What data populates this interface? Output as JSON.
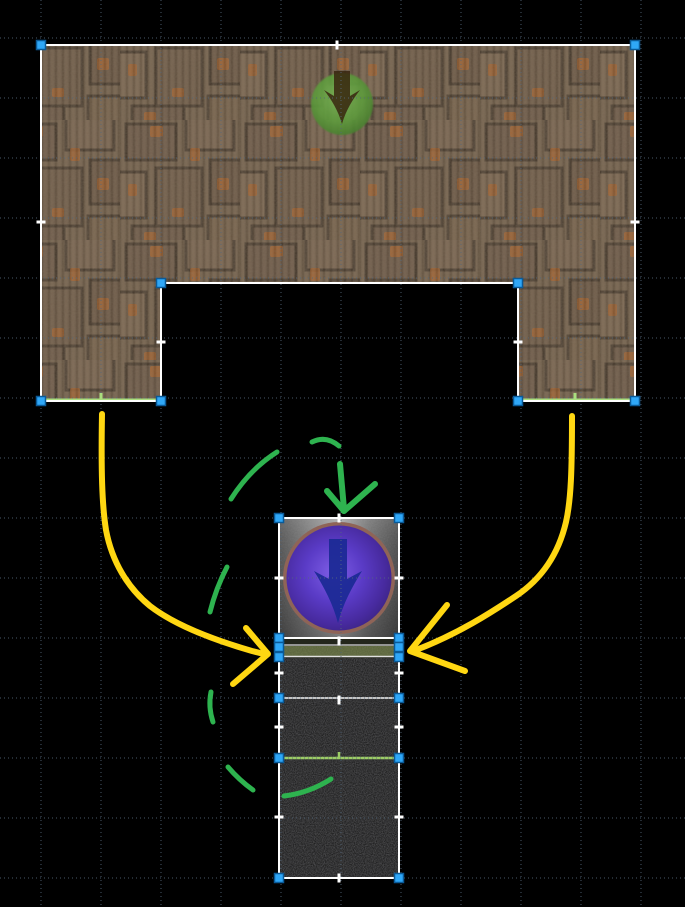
{
  "canvas": {
    "width": 685,
    "height": 907,
    "background": "#000000",
    "grid": {
      "spacing_px": 60,
      "style": "dotted",
      "color": "#54687c"
    }
  },
  "selection": {
    "outline_color": "#ffffff",
    "handle_fill": "#2fa7f7",
    "handle_stroke": "#0a5a98",
    "mid_handle_color": "#ffffff"
  },
  "objects": {
    "brick_wall": {
      "label": "brick bridge wall",
      "texture": "brown-brick",
      "selected": true
    },
    "base_platforms": {
      "label": "pillar base platform lines",
      "color": "#aade7e"
    },
    "spawn_marker": {
      "label": "green spawn marker",
      "icon": "arrow-down-icon",
      "circle_color": "#5d9a3c",
      "arrow_color": "#38260f"
    },
    "portal_orb": {
      "label": "purple portal orb tile",
      "icon": "arrow-down-icon",
      "orb_color": "#5a3bc6",
      "rim_color": "#8f6457",
      "arrow_color": "#1c2a96",
      "selected": true
    },
    "grass_strip": {
      "label": "grass platform strip",
      "color": "#57603a",
      "selected": true
    },
    "asphalt_column": {
      "label": "asphalt block column",
      "blocks": 3,
      "divider_gray": "#c4c4c4",
      "divider_green": "#9ccc65",
      "selected": true
    }
  },
  "annotations": {
    "yellow": {
      "color": "#ffd712",
      "shapes": "left-curved-arrow,right-curved-arrow"
    },
    "green": {
      "color": "#2eb34f",
      "shapes": "dashed-ellipse,down-arrow"
    }
  }
}
